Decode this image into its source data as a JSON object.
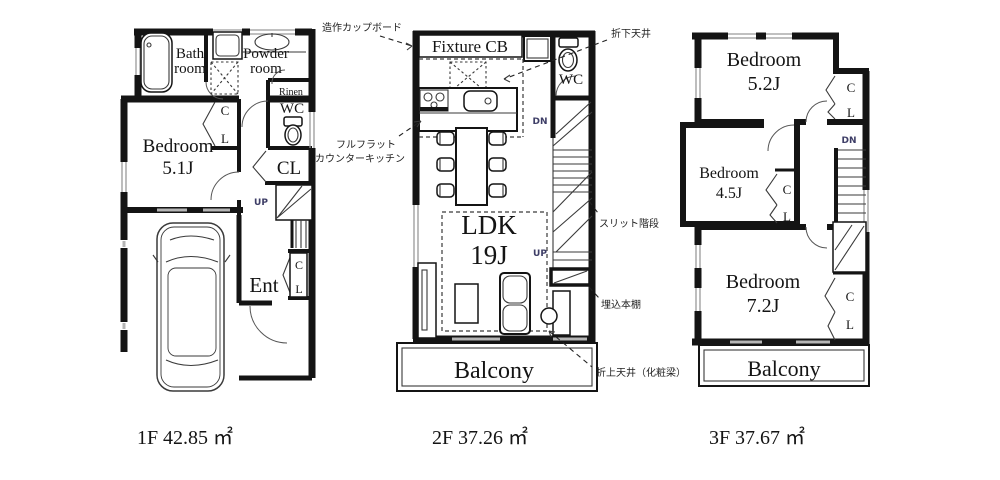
{
  "common": {
    "c": "C",
    "l": "L",
    "cl": "CL",
    "wc": "WC",
    "up": "UP",
    "dn": "DN",
    "balcony": "Balcony"
  },
  "floor1": {
    "caption": "1F 42.85 ㎡",
    "bath_line1": "Bath",
    "bath_line2": "room",
    "powder_line1": "Powder",
    "powder_line2": "room",
    "linen": "Rinen",
    "bedroom_line1": "Bedroom",
    "bedroom_line2": "5.1J",
    "entrance": "Ent"
  },
  "floor2": {
    "caption": "2F 37.26 ㎡",
    "fixture_cb": "Fixture CB",
    "ldk_line1": "LDK",
    "ldk_line2": "19J",
    "ann_cupboard": "造作カップボード",
    "ann_drop_ceiling": "折下天井",
    "ann_kitchen_line1": "フルフラット",
    "ann_kitchen_line2": "カウンターキッチン",
    "ann_slit_stairs": "スリット階段",
    "ann_bookshelf": "埋込本棚",
    "ann_raised_ceiling": "折上天井（化粧梁）"
  },
  "floor3": {
    "caption": "3F 37.67 ㎡",
    "bedroom_52_line1": "Bedroom",
    "bedroom_52_line2": "5.2J",
    "bedroom_45_line1": "Bedroom",
    "bedroom_45_line2": "4.5J",
    "bedroom_72_line1": "Bedroom",
    "bedroom_72_line2": "7.2J"
  },
  "colors": {
    "wall": "#141414",
    "annotation": "#1f1f1f",
    "up_dn": "#3d3d66"
  }
}
